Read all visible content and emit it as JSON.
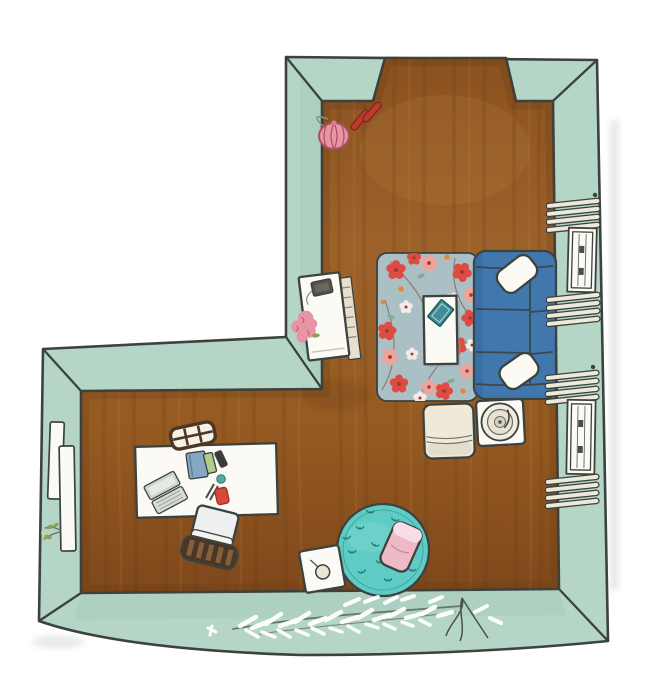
{
  "scene": {
    "title": "Hand-drawn watercolor top-down floor plan of an L-shaped room",
    "room": "L-shaped room with mint-green walls, wood floor and a doorway opening in the top wall"
  },
  "objects": {
    "doorway": "doorway opening in the top wall",
    "handbag": "pink handbag by the top wall",
    "shoes": "pair of red shoes",
    "console": "white sideboard with a radio and a pink bouquet",
    "rug": "gray-blue area rug with red blossom pattern",
    "coffee_table": "white coffee table with a teal book",
    "sofa": "blue three-seat sofa with two white pillows",
    "window_upper": "upper window with open louver shutters",
    "window_lower": "lower window with open louver shutters",
    "bench": "cream bench with folded blanket",
    "record_table": "square side table with record player",
    "desk": "white desk with laptop, books and stationery",
    "chair_top": "wooden ladder-back chair at the far side of the desk",
    "chair_bottom": "desk chair with slatted backrest",
    "shelves": "white shelves on the left wall with a leafy sprig",
    "pouf": "round teal pouf with a pink cushion",
    "side_table": "small white side table with a cup",
    "plant": "white feathery plant lying across the bottom wall"
  },
  "palette": {
    "bg": "#ffffff",
    "wall": "#b5d6c6",
    "wallShade": "#9ec4b2",
    "ink": "#3c423f",
    "floor1": "#8a5120",
    "floor2": "#9d622a",
    "floor3": "#955a21",
    "floor4": "#7f481b",
    "floorDark": "#5e3512",
    "floorLight": "#c8904e",
    "white": "#fbfaf4",
    "cream": "#efe9da",
    "sofaBlue": "#4078ad",
    "sofaDark": "#2d5e92",
    "rugBase": "#abc0c5",
    "rugShadow": "#8fa3a8",
    "flowerRed": "#df4b41",
    "flowerPink": "#efa39b",
    "flowerWhite": "#f3ebe7",
    "flowerCenter": "#9c3b31",
    "accentOrange": "#e08b3a",
    "leafTeal": "#7fae93",
    "branch": "#8a7466",
    "poufTeal": "#5ecbc5",
    "poufLight": "#8adbd4",
    "poufInk": "#1c6f6b",
    "pillowPink": "#eebac6",
    "pillowLight": "#f7dee6",
    "bagPink": "#e795a3",
    "bagDark": "#a84f63",
    "shoeRed": "#bf3a2d",
    "woodDark": "#4c3625",
    "woodMid": "#85603c",
    "laptopGray": "#ccd2cd",
    "laptopLight": "#e4e9e4",
    "bookBlue": "#85a7c6",
    "bookGreen": "#b4cc8b",
    "bookDark": "#3c3b36",
    "bookTeal": "#3f8e96",
    "itemRed": "#d8493a",
    "itemTeal": "#57aaa2",
    "leafGreen": "#89a15b",
    "stemGreen": "#5f6b5c",
    "rootGray": "#4c5148",
    "radioDark": "#55504a",
    "tableShade": "#e6e0d0",
    "seatGray": "#edeff1",
    "shadow": "#d3d8d7",
    "plantWhite": "#ffffff"
  }
}
